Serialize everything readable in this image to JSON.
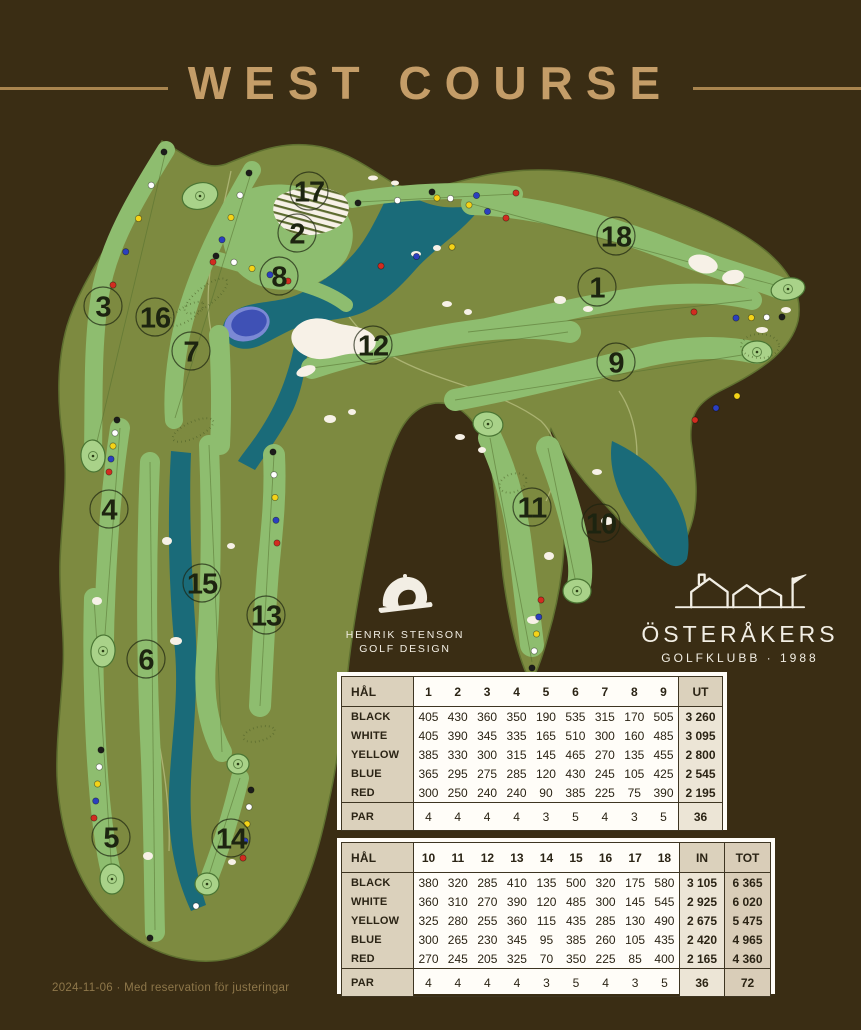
{
  "page": {
    "background": "#3a2d14"
  },
  "header": {
    "title": "WEST COURSE",
    "accent": "#c49d68",
    "rule_color": "#a9854f"
  },
  "logos": {
    "hsgd": {
      "line1": "HENRIK STENSON",
      "line2": "GOLF DESIGN"
    },
    "club": {
      "name": "ÖSTERÅKERS",
      "sub": "GOLFKLUBB · 1988"
    }
  },
  "map": {
    "colors": {
      "rough": "#7d8a40",
      "edge": "#5f7030",
      "fairway": "#8ebd6f",
      "green": "#a9d289",
      "greenline": "#4a7533",
      "water": "#1a6b79",
      "pond": "#3f51b5",
      "pondrim": "#7b89d4",
      "sand": "#f7f1e7",
      "marker": "#1d2410",
      "path": "#b6bd7e"
    },
    "tee_colors": {
      "black": "#1d1d1b",
      "white": "#ffffff",
      "yellow": "#f4d318",
      "blue": "#2b3fbf",
      "red": "#d22c20"
    },
    "holes": [
      {
        "n": "1",
        "x": 597,
        "y": 287
      },
      {
        "n": "2",
        "x": 297,
        "y": 233
      },
      {
        "n": "3",
        "x": 103,
        "y": 306
      },
      {
        "n": "4",
        "x": 109,
        "y": 509
      },
      {
        "n": "5",
        "x": 111,
        "y": 837
      },
      {
        "n": "6",
        "x": 146,
        "y": 659
      },
      {
        "n": "7",
        "x": 191,
        "y": 351
      },
      {
        "n": "8",
        "x": 279,
        "y": 276
      },
      {
        "n": "9",
        "x": 616,
        "y": 362
      },
      {
        "n": "10",
        "x": 601,
        "y": 523
      },
      {
        "n": "11",
        "x": 532,
        "y": 507
      },
      {
        "n": "12",
        "x": 373,
        "y": 345
      },
      {
        "n": "13",
        "x": 266,
        "y": 615
      },
      {
        "n": "14",
        "x": 231,
        "y": 838
      },
      {
        "n": "15",
        "x": 202,
        "y": 583
      },
      {
        "n": "16",
        "x": 155,
        "y": 317
      },
      {
        "n": "17",
        "x": 309,
        "y": 191
      },
      {
        "n": "18",
        "x": 616,
        "y": 236
      }
    ]
  },
  "scorecard": {
    "front": {
      "col_header": "HÅL",
      "holes": [
        "1",
        "2",
        "3",
        "4",
        "5",
        "6",
        "7",
        "8",
        "9"
      ],
      "sum_label": "UT",
      "rows": [
        {
          "label": "BLACK",
          "values": [
            "405",
            "430",
            "360",
            "350",
            "190",
            "535",
            "315",
            "170",
            "505"
          ],
          "sum": "3 260"
        },
        {
          "label": "WHITE",
          "values": [
            "405",
            "390",
            "345",
            "335",
            "165",
            "510",
            "300",
            "160",
            "485"
          ],
          "sum": "3 095"
        },
        {
          "label": "YELLOW",
          "values": [
            "385",
            "330",
            "300",
            "315",
            "145",
            "465",
            "270",
            "135",
            "455"
          ],
          "sum": "2 800"
        },
        {
          "label": "BLUE",
          "values": [
            "365",
            "295",
            "275",
            "285",
            "120",
            "430",
            "245",
            "105",
            "425"
          ],
          "sum": "2 545"
        },
        {
          "label": "RED",
          "values": [
            "300",
            "250",
            "240",
            "240",
            "90",
            "385",
            "225",
            "75",
            "390"
          ],
          "sum": "2 195"
        }
      ],
      "par": {
        "label": "PAR",
        "values": [
          "4",
          "4",
          "4",
          "4",
          "3",
          "5",
          "4",
          "3",
          "5"
        ],
        "sum": "36"
      }
    },
    "back": {
      "col_header": "HÅL",
      "holes": [
        "10",
        "11",
        "12",
        "13",
        "14",
        "15",
        "16",
        "17",
        "18"
      ],
      "sum_label": "IN",
      "tot_label": "TOT",
      "rows": [
        {
          "label": "BLACK",
          "values": [
            "380",
            "320",
            "285",
            "410",
            "135",
            "500",
            "320",
            "175",
            "580"
          ],
          "sum": "3 105",
          "tot": "6 365"
        },
        {
          "label": "WHITE",
          "values": [
            "360",
            "310",
            "270",
            "390",
            "120",
            "485",
            "300",
            "145",
            "545"
          ],
          "sum": "2 925",
          "tot": "6 020"
        },
        {
          "label": "YELLOW",
          "values": [
            "325",
            "280",
            "255",
            "360",
            "115",
            "435",
            "285",
            "130",
            "490"
          ],
          "sum": "2 675",
          "tot": "5 475"
        },
        {
          "label": "BLUE",
          "values": [
            "300",
            "265",
            "230",
            "345",
            "95",
            "385",
            "260",
            "105",
            "435"
          ],
          "sum": "2 420",
          "tot": "4 965"
        },
        {
          "label": "RED",
          "values": [
            "270",
            "245",
            "205",
            "325",
            "70",
            "350",
            "225",
            "85",
            "400"
          ],
          "sum": "2 165",
          "tot": "4 360"
        }
      ],
      "par": {
        "label": "PAR",
        "values": [
          "4",
          "4",
          "4",
          "4",
          "3",
          "5",
          "4",
          "3",
          "5"
        ],
        "sum": "36",
        "tot": "72"
      }
    }
  },
  "footer": {
    "text": "2024-11-06 · Med reservation för justeringar"
  }
}
